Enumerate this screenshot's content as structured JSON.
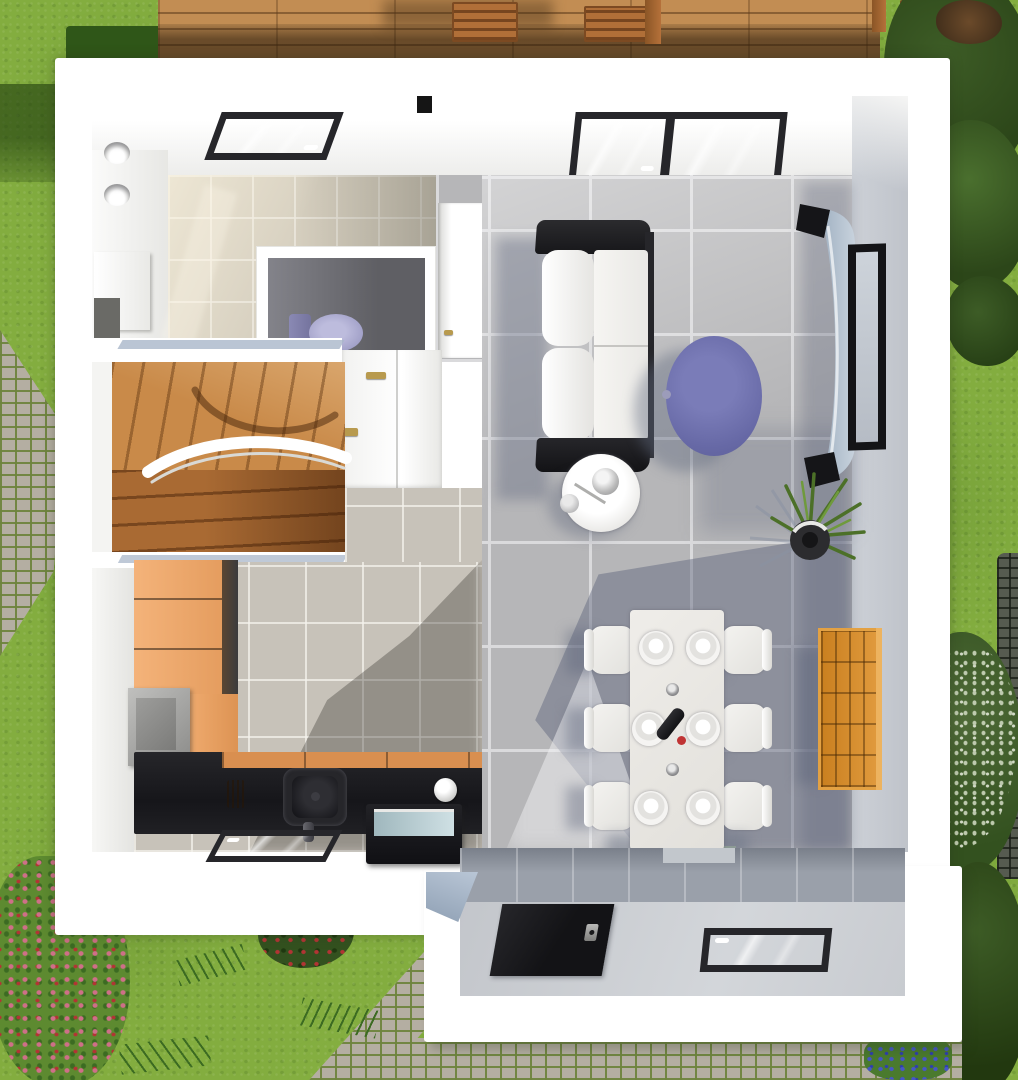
{
  "meta": {
    "type": "3d floor plan render",
    "view": "top-down",
    "width_px": 1018,
    "height_px": 1080
  },
  "palette": {
    "grass": "#83ad3f",
    "grass_dark": "#6d9834",
    "hedge_shadow": "#2f5618",
    "deck_wood": "#c28d53",
    "chair_wood": "#b06f38",
    "wall_white": "#ffffff",
    "wall_cap_blue": "#a9b7c9",
    "bath_tile": "#d8d1c1",
    "wc_floor": "#76767a",
    "toilet_lavender": "#a3a2c9",
    "stair_wood": "#c98a49",
    "stair_wood_dark": "#a96a33",
    "kitchen_tile": "#c7c2b9",
    "cabinet_orange": "#eda868",
    "counter_black": "#1c1c1f",
    "counter_front_orange": "#d98f50",
    "appliance_gray": "#a5a5a3",
    "floor_tile": "#b6b6b8",
    "grout": "#dadadc",
    "floor_shadow": "#5c6478",
    "sofa_white": "#f3f2ef",
    "sofa_black": "#1f1f22",
    "coffee_table_purple": "#6f71ad",
    "tv_console_blue": "#b3c0cf",
    "frame_black": "#26262a",
    "plant_green": "#4c7028",
    "dining_table_white": "#eae8e4",
    "shelf_orange": "#d8912f",
    "porch_floor": "#c9ccd1",
    "porch_band_gray": "#9aa0aa",
    "door_black": "#17171a",
    "glass_blue": "#bcd3d8",
    "bottle_cap_red": "#c03434",
    "flower_pink": "#cf6f88",
    "flower_red": "#b23434",
    "flower_blue": "#4656c8",
    "blossom": "#ccd6bd",
    "tree_dark": "#2c4619",
    "tree_mid": "#3d5c26"
  },
  "scene": {
    "exterior": {
      "ground": "lawn",
      "deck": "wooden terrace with outdoor chairs along the top edge",
      "paths": [
        "cobblestone path upper-left",
        "cobblestone path at bottom",
        "dark stone path right edge"
      ],
      "vegetation": [
        "hedge shadow top-left",
        "dense trees upper-right",
        "flowering tree mid-right",
        "shrubs lower-right",
        "pink flower bed lower-left",
        "red-berry bush bottom-center",
        "blue flowers bottom-right"
      ]
    },
    "rooms": [
      {
        "name": "bathroom",
        "floor": "beige tiles",
        "items": [
          "roof window",
          "two wall lights",
          "vanity cabinet"
        ]
      },
      {
        "name": "wc",
        "floor": "dark gray",
        "items": [
          "lavender toilet"
        ]
      },
      {
        "name": "hallway",
        "items": [
          "white door with brass handle",
          "built-in closet with two brass handles"
        ]
      },
      {
        "name": "staircase",
        "items": [
          "wooden winder stairs",
          "white curved railing"
        ]
      },
      {
        "name": "kitchen",
        "floor": "beige tiles",
        "items": [
          "tall orange cabinet units",
          "gray appliance",
          "black worktop",
          "black sink with faucet",
          "utensil pot",
          "white kettle",
          "oven with glass top",
          "window in south wall"
        ]
      },
      {
        "name": "living-dining room",
        "floor": "gray tiles",
        "items": [
          "large two-pane roof window",
          "white sofa with black armrests",
          "round white side table with chrome lamp",
          "purple oval coffee table",
          "curved wall console",
          "black tv frame",
          "potted green plant",
          "white dining table with six place settings, two candle holders and a wine bottle",
          "six white chairs",
          "orange cube shelf"
        ]
      },
      {
        "name": "entrance porch",
        "items": [
          "black front door with handle",
          "window",
          "light gray floor"
        ]
      }
    ]
  }
}
